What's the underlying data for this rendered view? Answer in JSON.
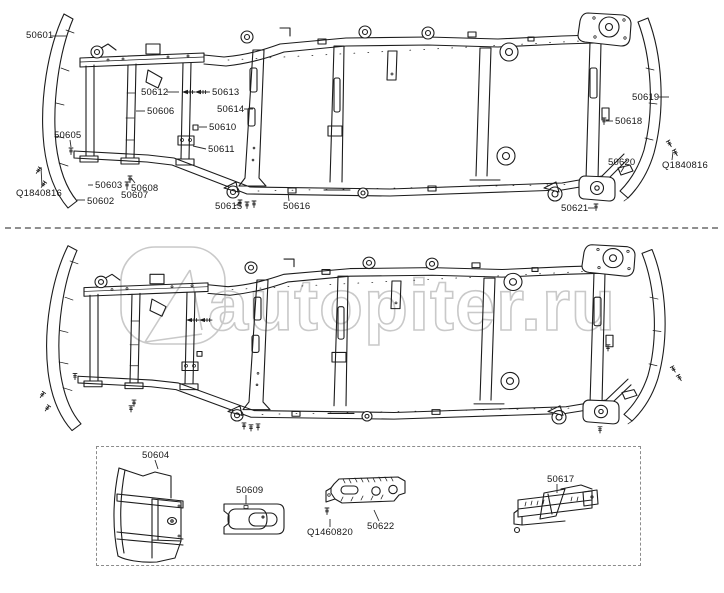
{
  "page": {
    "background": "#ffffff",
    "ink_color": "#1c1c1c"
  },
  "watermark": {
    "text": "autopiter.ru",
    "color": "#c9c9c9",
    "logo": "autopiter-rounded-square-a-logo"
  },
  "diagram": {
    "type": "exploded-parts-diagram",
    "subject": "vehicle frame assembly",
    "views": {
      "top_labeled_view": "frame assembly with part callouts",
      "middle_unlabeled_view": "frame assembly duplicate view (no callouts)",
      "inset_box_view": "detail parts inset"
    },
    "top_view_labels": [
      {
        "text": "50601",
        "x": 26,
        "y": 31,
        "line": [
          51,
          36,
          67,
          36
        ]
      },
      {
        "text": "50605",
        "x": 54,
        "y": 131,
        "line": [
          70,
          140,
          71,
          147
        ]
      },
      {
        "text": "Q1840816",
        "x": 16,
        "y": 189,
        "line": [
          42,
          187,
          41,
          167
        ]
      },
      {
        "text": "50603",
        "x": 95,
        "y": 181,
        "line": [
          93,
          185,
          88,
          185
        ]
      },
      {
        "text": "50602",
        "x": 87,
        "y": 197,
        "line": [
          85,
          200,
          77,
          200
        ]
      },
      {
        "text": "50608",
        "x": 131,
        "y": 184,
        "line": [
          135,
          183,
          131,
          178
        ]
      },
      {
        "text": "50607",
        "x": 121,
        "y": 191,
        "line": [
          127,
          190,
          127,
          184
        ]
      },
      {
        "text": "50612",
        "x": 141,
        "y": 88,
        "line": [
          167,
          92,
          179,
          92
        ]
      },
      {
        "text": "50613",
        "x": 212,
        "y": 88,
        "line": [
          210,
          92,
          200,
          92
        ]
      },
      {
        "text": "50606",
        "x": 147,
        "y": 107,
        "line": [
          145,
          111,
          136,
          111
        ]
      },
      {
        "text": "50614",
        "x": 217,
        "y": 105,
        "line": [
          244,
          109,
          253,
          109
        ]
      },
      {
        "text": "50610",
        "x": 209,
        "y": 123,
        "line": [
          207,
          127,
          199,
          127
        ]
      },
      {
        "text": "50611",
        "x": 208,
        "y": 145,
        "line": [
          206,
          149,
          193,
          146
        ]
      },
      {
        "text": "50615",
        "x": 215,
        "y": 202,
        "line": [
          234,
          206,
          239,
          204
        ]
      },
      {
        "text": "50616",
        "x": 283,
        "y": 202,
        "line": [
          289,
          201,
          288,
          192
        ]
      },
      {
        "text": "50619",
        "x": 632,
        "y": 93,
        "line": [
          659,
          97,
          669,
          97
        ]
      },
      {
        "text": "50618",
        "x": 615,
        "y": 117,
        "line": [
          613,
          121,
          606,
          121
        ]
      },
      {
        "text": "50620",
        "x": 608,
        "y": 158,
        "line": [
          624,
          167,
          621,
          172
        ]
      },
      {
        "text": "Q1840816",
        "x": 662,
        "y": 161,
        "line": [
          672,
          160,
          673,
          152
        ]
      },
      {
        "text": "50621",
        "x": 561,
        "y": 204,
        "line": [
          588,
          208,
          595,
          208
        ]
      }
    ],
    "inset_labels": [
      {
        "text": "50604",
        "x": 142,
        "y": 451,
        "line": [
          155,
          460,
          158,
          469
        ]
      },
      {
        "text": "50609",
        "x": 236,
        "y": 486,
        "line": [
          246,
          495,
          246,
          504
        ]
      },
      {
        "text": "Q1460820",
        "x": 307,
        "y": 528,
        "line": [
          330,
          527,
          330,
          519
        ]
      },
      {
        "text": "50622",
        "x": 367,
        "y": 522,
        "line": [
          379,
          521,
          374,
          510
        ]
      },
      {
        "text": "50617",
        "x": 547,
        "y": 475,
        "line": [
          557,
          484,
          557,
          493
        ]
      }
    ]
  }
}
